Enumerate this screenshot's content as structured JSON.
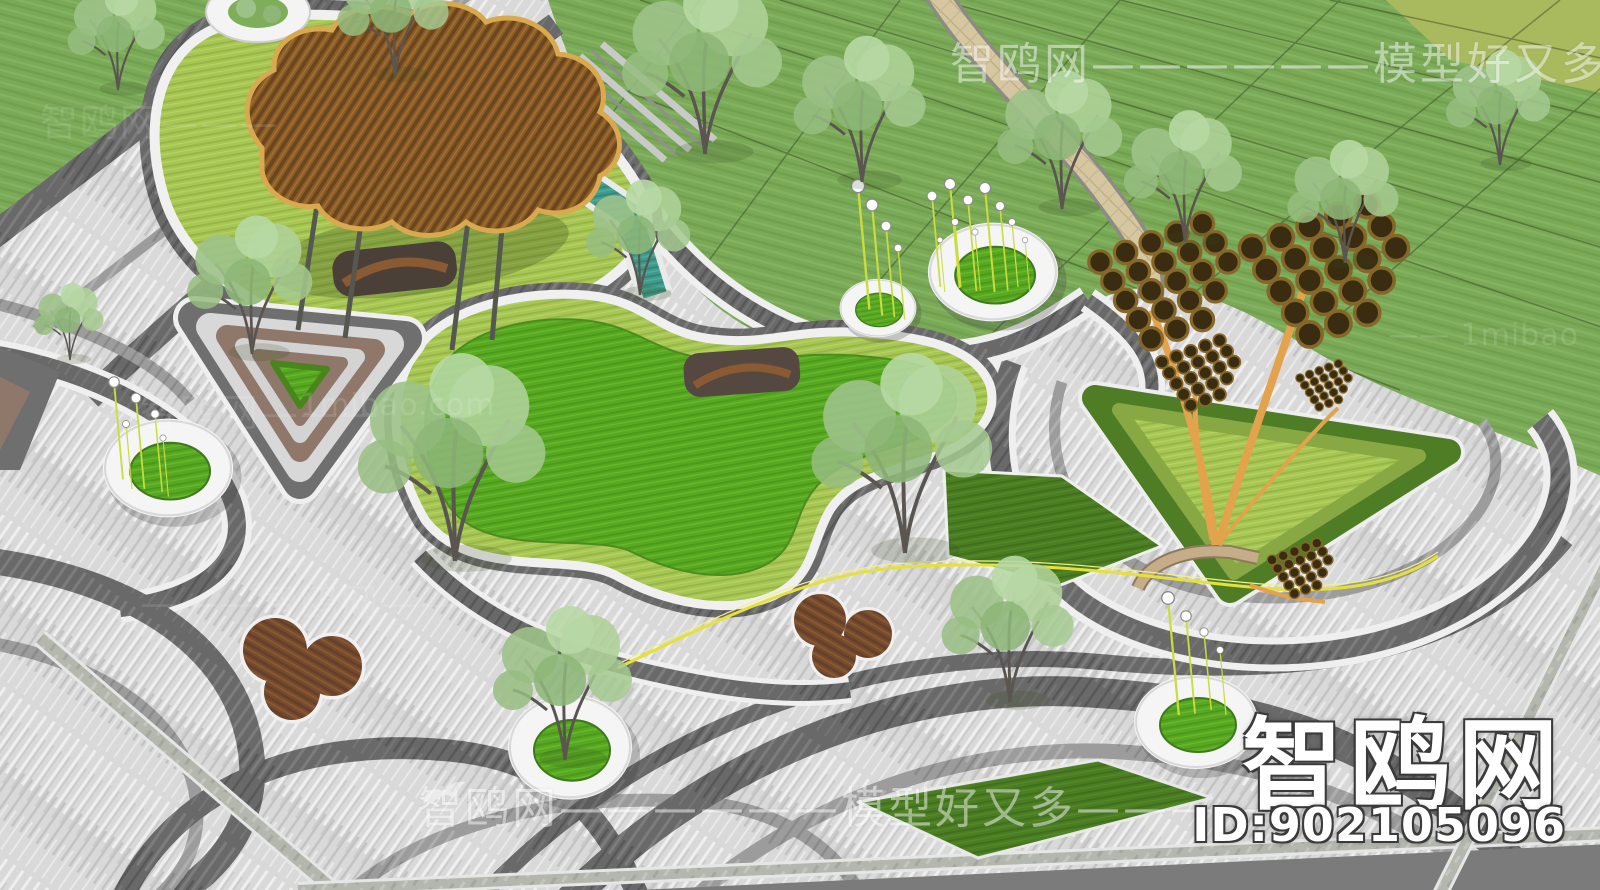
{
  "watermarks": {
    "top_banner": "智鸥网——————模型好又多———",
    "bottom_banner": "智鸥网——————模型好又多————",
    "site_logo": "智鸥网",
    "model_id": "ID:902105096",
    "tile_1": "智鸥网———",
    "tile_2": "—智鸥网———",
    "tile_3": "———智鸥网——",
    "tile_mibao_1": "1mibao.com",
    "tile_mibao_2": "—— 1mibao"
  },
  "colors": {
    "paving_light": "#dcdcdc",
    "paving_dark": "#6b6b6b",
    "lawn_bright": "#58a822",
    "lawn_hedge": "#a8c653",
    "lawn_dark": "#4b7d23",
    "lawn_field": "#7aa957",
    "water_teal": "#3f9c8c",
    "canopy_wood": "#8a5c28",
    "canopy_trim": "#d9a94f",
    "deck_wood": "#774c2c",
    "sculpture_gold": "#e2a34c",
    "accent_yellow": "#e6e03a",
    "watermark_white": "#ffffff"
  }
}
